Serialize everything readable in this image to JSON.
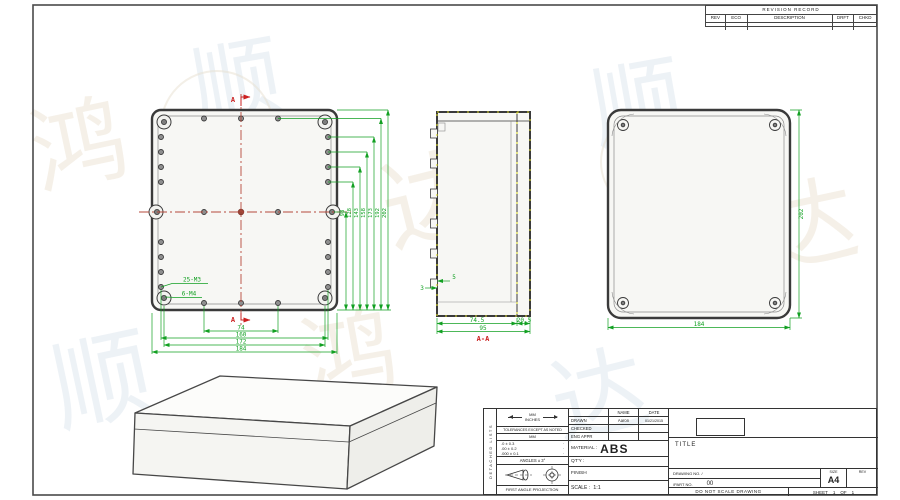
{
  "colors": {
    "outline": "#3a3a3a",
    "dimension_green": "#12a022",
    "centerline_red": "#b5493b",
    "section_red": "#cc2020",
    "hatch_yellow": "#d6d62a"
  },
  "watermark": {
    "chars": [
      "顺",
      "达",
      "鸿",
      "顺",
      "达",
      "顺",
      "鸿",
      "达"
    ]
  },
  "revision_table": {
    "title": "REVISION RECORD",
    "columns": [
      "REV",
      "ECO",
      "DESCRIPTION",
      "DRFT",
      "CHKD"
    ]
  },
  "views": {
    "front": {
      "section_marker_top": "A",
      "section_marker_bottom": "A",
      "thread_label_m3": "25-M3",
      "thread_label_m4": "6-M4",
      "dims_bottom": [
        "74",
        "160",
        "172",
        "184"
      ],
      "dims_right": [
        "98",
        "128",
        "143",
        "158",
        "173",
        "192",
        "202"
      ]
    },
    "section": {
      "label": "A-A",
      "dim_depth_body": "74.5",
      "dim_depth_lid": "20.5",
      "dim_depth_total": "95",
      "dim_wall": "3",
      "dim_boss": "5"
    },
    "back": {
      "dim_width": "184",
      "dim_height": "202"
    }
  },
  "title_block": {
    "side_label": "DETACHED LISTS",
    "units_mm": "MM",
    "units_in": "INCHES",
    "tolerances_note": "TOLERANCES EXCEPT AS NOTED",
    "tol_header": "MM",
    "tol_rows": [
      ".0 ± 0.3",
      ".00 ± 0.2",
      ".000 ± 0.1"
    ],
    "tol_marks": [
      "·",
      "·",
      "·"
    ],
    "angles": "ANGLES ± 3°",
    "projection": "FIRST ANGLE PROJECTION",
    "name_header": "NAME",
    "date_header": "DATE",
    "drawn_label": "DRAWN",
    "drawn_name": "Aaron",
    "drawn_date": "01/21/2015",
    "checked_label": "CHECKED",
    "eng_appr_label": "ENG APPR",
    "material_label": "MATERIAL :",
    "material_value": "ABS",
    "qty_label": "QT'Y :",
    "finish_label": "FINISH",
    "scale_label": "SCALE :",
    "scale_value": "1:1",
    "title_label": "TITLE",
    "drawing_no_label": "DRAWING NO. /",
    "part_no_label": "/PART  NO.",
    "part_no_value": "00",
    "size_label": "SIZE",
    "size_value": "A4",
    "rev_label": "REV",
    "do_not_scale": "DO NOT SCALE DRAWING",
    "sheet_label": "SHEET",
    "sheet_no": "1",
    "of_label": "OF",
    "sheet_total": "1"
  }
}
